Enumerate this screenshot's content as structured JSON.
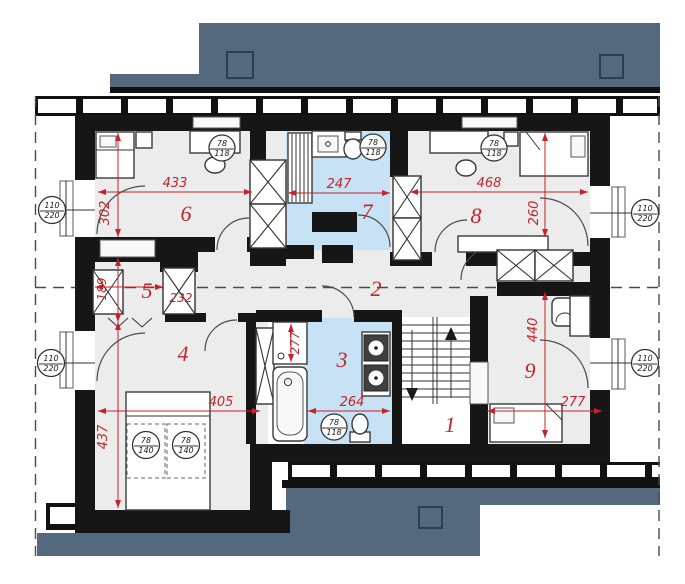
{
  "plan_type": "attic floor plan",
  "colors": {
    "roof": "#54687e",
    "wall": "#161616",
    "room_floor": "#ececec",
    "bathroom_floor": "#c7e2f4",
    "dimension_red": "#c4232b"
  },
  "rooms": [
    {
      "number": "1"
    },
    {
      "number": "2"
    },
    {
      "number": "3"
    },
    {
      "number": "4"
    },
    {
      "number": "5"
    },
    {
      "number": "6"
    },
    {
      "number": "7"
    },
    {
      "number": "8"
    },
    {
      "number": "9"
    }
  ],
  "dimensions": {
    "room6_width": "433",
    "room7_width": "247",
    "room8_width": "468",
    "room6_depth": "302",
    "room5_depth": "189",
    "room4_depth": "437",
    "room8_depth": "260",
    "room9_depth": "440",
    "room5_width": "232",
    "room4_width": "405",
    "room3_width": "264",
    "room9_width": "277",
    "room3_depth": "277"
  },
  "markers": {
    "window": {
      "top": "110",
      "bottom": "220"
    },
    "skylight_small": {
      "top": "78",
      "bottom": "118"
    },
    "skylight_large": {
      "top": "78",
      "bottom": "140"
    }
  }
}
